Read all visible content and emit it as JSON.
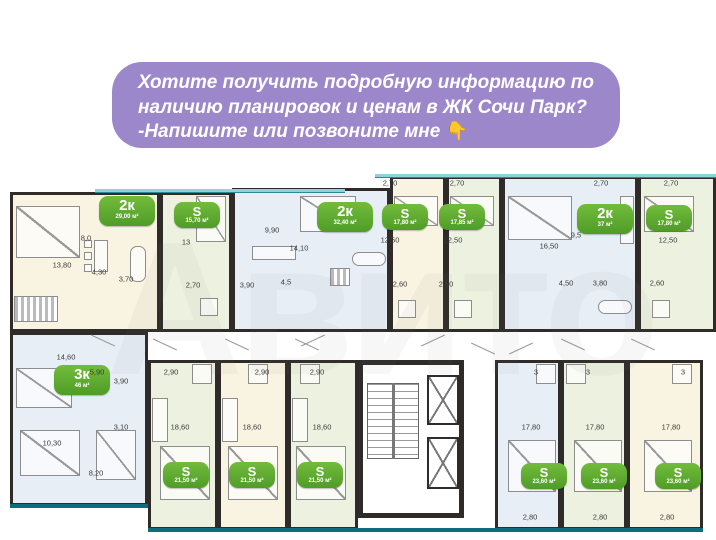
{
  "banner": {
    "text_line1": "Хотите получить подробную информацию по",
    "text_line2": "наличию планировок и ценам в ЖК Сочи Парк?",
    "text_line3": "-Напишите или позвоните мне",
    "pointer_emoji": "👇",
    "background_color": "#9c87ca"
  },
  "watermark": "Авито",
  "plan": {
    "badge_color": "#5aa62f",
    "badges": [
      {
        "type": "2к",
        "area": "29,00 м²"
      },
      {
        "type": "S",
        "area": "15,70 м²"
      },
      {
        "type": "2к",
        "area": "32,40 м²"
      },
      {
        "type": "S",
        "area": "17,80 м²"
      },
      {
        "type": "S",
        "area": "17,85 м²"
      },
      {
        "type": "2к",
        "area": "37 м²"
      },
      {
        "type": "S",
        "area": "17,80 м²"
      },
      {
        "type": "3к",
        "area": "46 м²"
      },
      {
        "type": "S",
        "area": "21,50 м²"
      },
      {
        "type": "S",
        "area": "21,50 м²"
      },
      {
        "type": "S",
        "area": "21,50 м²"
      },
      {
        "type": "S",
        "area": "23,60 м²"
      },
      {
        "type": "S",
        "area": "23,60 м²"
      },
      {
        "type": "S",
        "area": "23,60 м²"
      }
    ],
    "labels": [
      "8,0",
      "13,80",
      "4,30",
      "3,70",
      "13",
      "2,70",
      "9,90",
      "14,10",
      "3,90",
      "4,5",
      "2,70",
      "2,70",
      "12,50",
      "12,50",
      "2,60",
      "2,60",
      "2,70",
      "2,70",
      "9,5",
      "16,50",
      "12,50",
      "4,50",
      "3,80",
      "2,60",
      "14,60",
      "5,90",
      "3,90",
      "2,90",
      "3,10",
      "10,30",
      "8,20",
      "18,60",
      "2,90",
      "2,90",
      "18,60",
      "18,60",
      "3",
      "3",
      "3",
      "17,80",
      "17,80",
      "17,80",
      "2,80",
      "2,80",
      "2,80"
    ]
  }
}
